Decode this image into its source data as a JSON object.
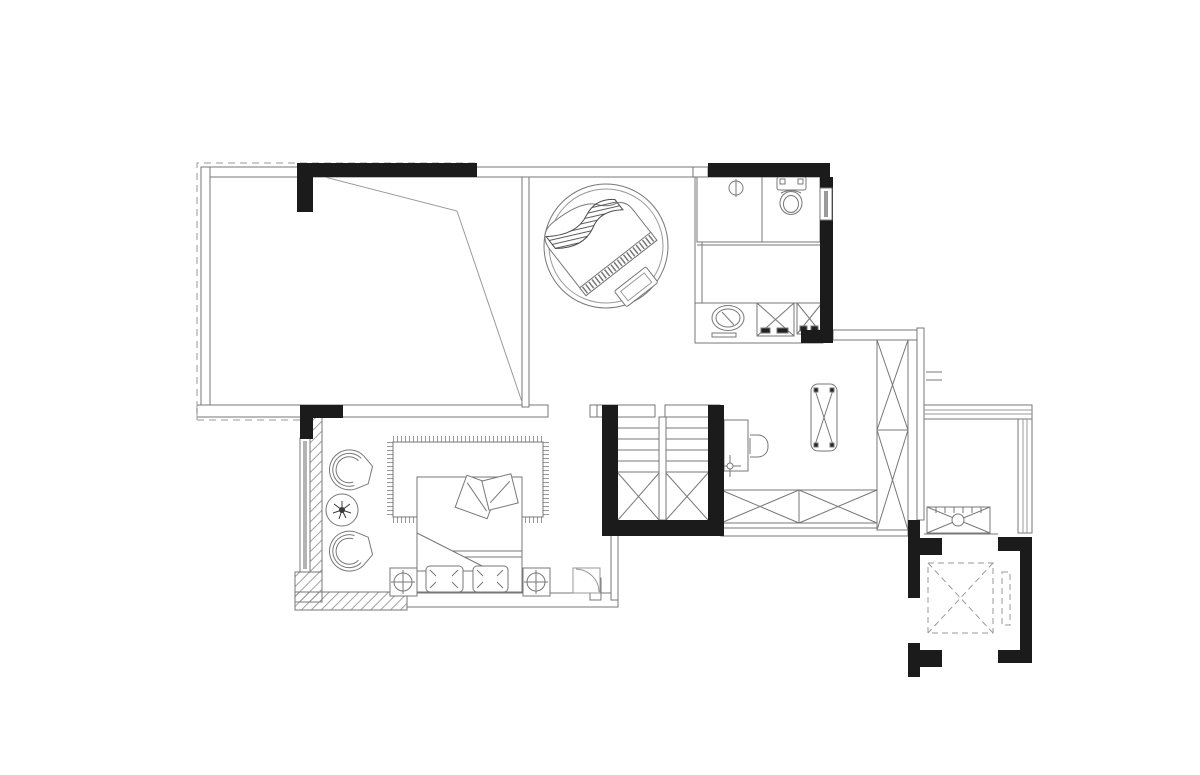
{
  "canvas": {
    "width": 1200,
    "height": 775,
    "background": "#ffffff"
  },
  "palette": {
    "wall": "#1b1b1b",
    "line": "#777777",
    "light_line": "#9a9a9a",
    "hatch": "#8a8a8a",
    "dark_detail": "#3a3a3a",
    "glass": "#b3b3b3",
    "paper": "#ffffff"
  },
  "plan": {
    "type": "residential-floor-plan",
    "rooms": [
      {
        "id": "terrace",
        "label": "sloped-roof terrace"
      },
      {
        "id": "piano-lounge",
        "label": "piano lounge"
      },
      {
        "id": "bathroom",
        "label": "bathroom with shower, toilet and vanity"
      },
      {
        "id": "staircase",
        "label": "u-shaped staircase"
      },
      {
        "id": "bedroom",
        "label": "bedroom"
      },
      {
        "id": "study-dressing",
        "label": "study / dressing corridor"
      },
      {
        "id": "balcony",
        "label": "equipment balcony"
      },
      {
        "id": "elevator",
        "label": "elevator shaft"
      }
    ],
    "furniture": [
      "grand-piano",
      "piano-bench",
      "area-rug-round",
      "shower-tray",
      "floor-drain",
      "toilet",
      "vanity-counter",
      "sink",
      "washing-machine",
      "dryer",
      "desk",
      "desk-chair",
      "ceiling-light-symbol",
      "ottoman-bench",
      "wardrobe-column",
      "wardrobe-row",
      "double-bed",
      "fringed-rug",
      "sleeping-pillows",
      "throw-pillows",
      "nightstand-left",
      "nightstand-right",
      "table-lamp-left",
      "table-lamp-right",
      "lounge-chair-top",
      "lounge-chair-bottom",
      "side-table",
      "potted-plant",
      "ac-condenser-unit",
      "elevator-car",
      "elevator-door"
    ]
  }
}
